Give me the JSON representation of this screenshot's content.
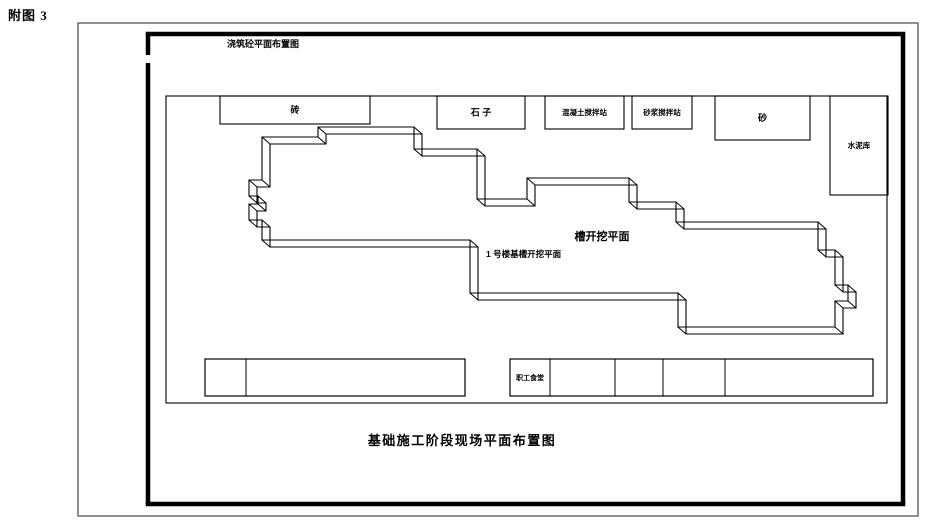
{
  "page": {
    "figure_label": "附图 3"
  },
  "drawing": {
    "top_label": {
      "text": "浇筑砼平面布置图",
      "x": 263,
      "y": 47,
      "fs": 9
    },
    "caption": {
      "text": "基础施工阶段现场平面布置图",
      "x": 462,
      "y": 445,
      "fs": 13
    },
    "borders": {
      "outer": {
        "x": 78,
        "y": 23,
        "w": 840,
        "h": 493
      },
      "fence": {
        "left_x": 148,
        "top_y": 34,
        "right_x": 903,
        "bottom_y": 504,
        "gate_gap_y": [
          55,
          63
        ],
        "thickness": 4.5
      },
      "site": {
        "x": 166,
        "y": 96,
        "w": 721,
        "h": 307
      }
    },
    "storage_boxes": [
      {
        "label": "砖",
        "x": 220,
        "y": 96,
        "w": 150,
        "h": 28,
        "fs": 9
      },
      {
        "label": "石  子",
        "x": 437,
        "y": 96,
        "w": 88,
        "h": 33,
        "fs": 9
      },
      {
        "label": "混凝土搅拌站",
        "x": 545,
        "y": 96,
        "w": 79,
        "h": 33,
        "fs": 7.5
      },
      {
        "label": "砂浆搅拌站",
        "x": 632,
        "y": 96,
        "w": 60,
        "h": 33,
        "fs": 7.5
      },
      {
        "label": "砂",
        "x": 715,
        "y": 96,
        "w": 95,
        "h": 44,
        "fs": 9
      },
      {
        "label": "水泥库",
        "x": 830,
        "y": 96,
        "w": 58,
        "h": 99,
        "fs": 7.5
      }
    ],
    "bottom_boxes": {
      "left": {
        "x": 205,
        "y": 359,
        "w": 260,
        "h": 37,
        "dividers": [
          246
        ],
        "label": "",
        "fs": 7
      },
      "right": {
        "x": 510,
        "y": 359,
        "w": 363,
        "h": 37,
        "dividers": [
          550,
          615,
          663,
          725
        ],
        "label": "职工食堂",
        "label_x": 530,
        "fs": 7
      }
    },
    "excavation": {
      "label_main": {
        "text": "槽开挖平面",
        "x": 602,
        "y": 240,
        "fs": 11
      },
      "label_sub": {
        "text": "1 号楼基槽开挖平面",
        "x": 486,
        "y": 257,
        "fs": 8.5
      },
      "offset": [
        8,
        7
      ],
      "points": [
        [
          262,
          137
        ],
        [
          318,
          137
        ],
        [
          318,
          127
        ],
        [
          414,
          127
        ],
        [
          414,
          149
        ],
        [
          477,
          149
        ],
        [
          477,
          199
        ],
        [
          527,
          199
        ],
        [
          527,
          178
        ],
        [
          629,
          178
        ],
        [
          629,
          202
        ],
        [
          676,
          202
        ],
        [
          676,
          222
        ],
        [
          818,
          222
        ],
        [
          818,
          250
        ],
        [
          835,
          250
        ],
        [
          835,
          285
        ],
        [
          848,
          285
        ],
        [
          848,
          301
        ],
        [
          835,
          301
        ],
        [
          835,
          327
        ],
        [
          678,
          327
        ],
        [
          678,
          293
        ],
        [
          470,
          293
        ],
        [
          470,
          240
        ],
        [
          262,
          240
        ],
        [
          262,
          220
        ],
        [
          249,
          220
        ],
        [
          249,
          204
        ],
        [
          258,
          204
        ],
        [
          258,
          196
        ],
        [
          249,
          196
        ],
        [
          249,
          180
        ],
        [
          262,
          180
        ]
      ]
    }
  }
}
